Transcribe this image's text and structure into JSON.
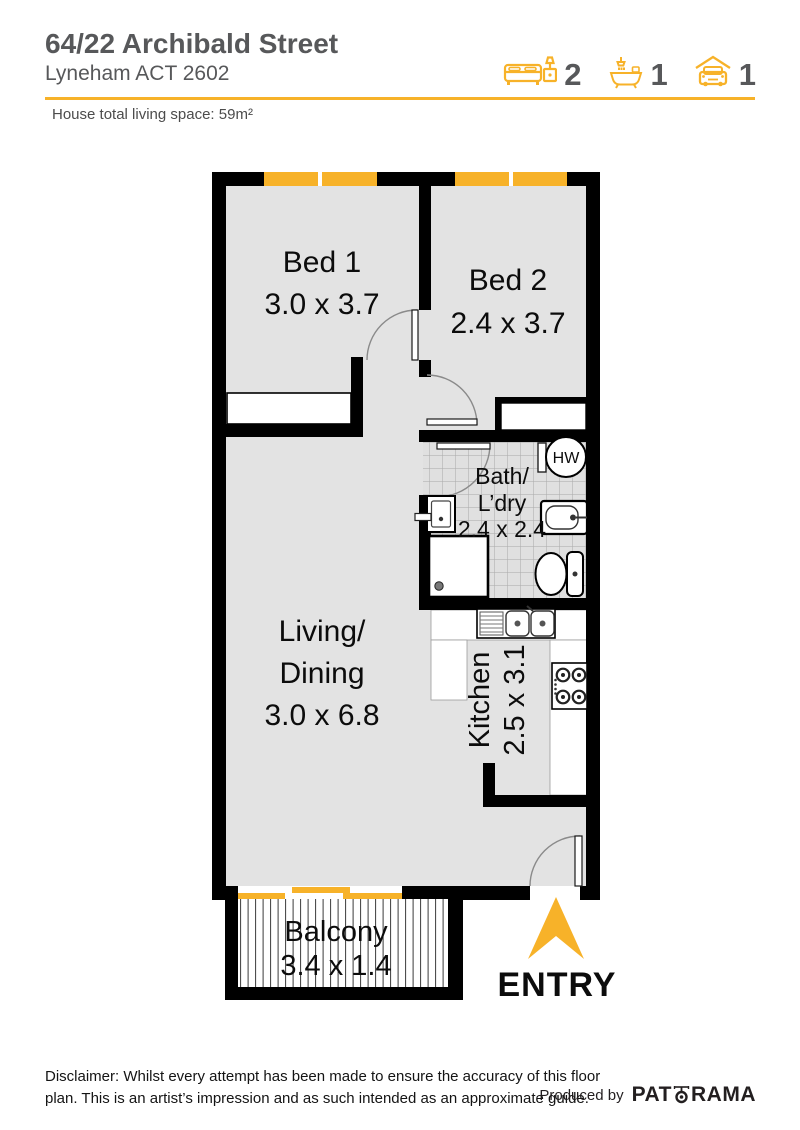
{
  "header": {
    "title": "64/22 Archibald Street",
    "subtitle": "Lyneham ACT 2602",
    "living_space": "House total living space: 59m²",
    "stats": {
      "beds": "2",
      "baths": "1",
      "cars": "1"
    }
  },
  "plan": {
    "rooms": {
      "bed1": {
        "name": "Bed 1",
        "dims": "3.0 x 3.7"
      },
      "bed2": {
        "name": "Bed 2",
        "dims": "2.4 x 3.7"
      },
      "bath": {
        "name_line1": "Bath/",
        "name_line2": "L’dry",
        "dims": "2.4 x 2.4"
      },
      "living": {
        "name_line1": "Living/",
        "name_line2": "Dining",
        "dims": "3.0 x 6.8"
      },
      "kitchen": {
        "name": "Kitchen",
        "dims": "2.5 x 3.1"
      },
      "balcony": {
        "name": "Balcony",
        "dims": "3.4 x 1.4"
      }
    },
    "labels": {
      "hot_water": "HW",
      "entry": "ENTRY"
    }
  },
  "footer": {
    "disclaimer_line1": "Disclaimer: Whilst every attempt has been made to ensure the accuracy of this floor",
    "disclaimer_line2": "plan. This is an artist’s impression and as such intended as an approximate guide.",
    "produced_by": "Produced by",
    "brand_prefix": "PAT",
    "brand_suffix": "RAMA"
  },
  "colors": {
    "accent_yellow": "#F7B229",
    "wall_black": "#000000",
    "room_gray": "#E3E3E3",
    "heading_gray": "#57585A"
  }
}
